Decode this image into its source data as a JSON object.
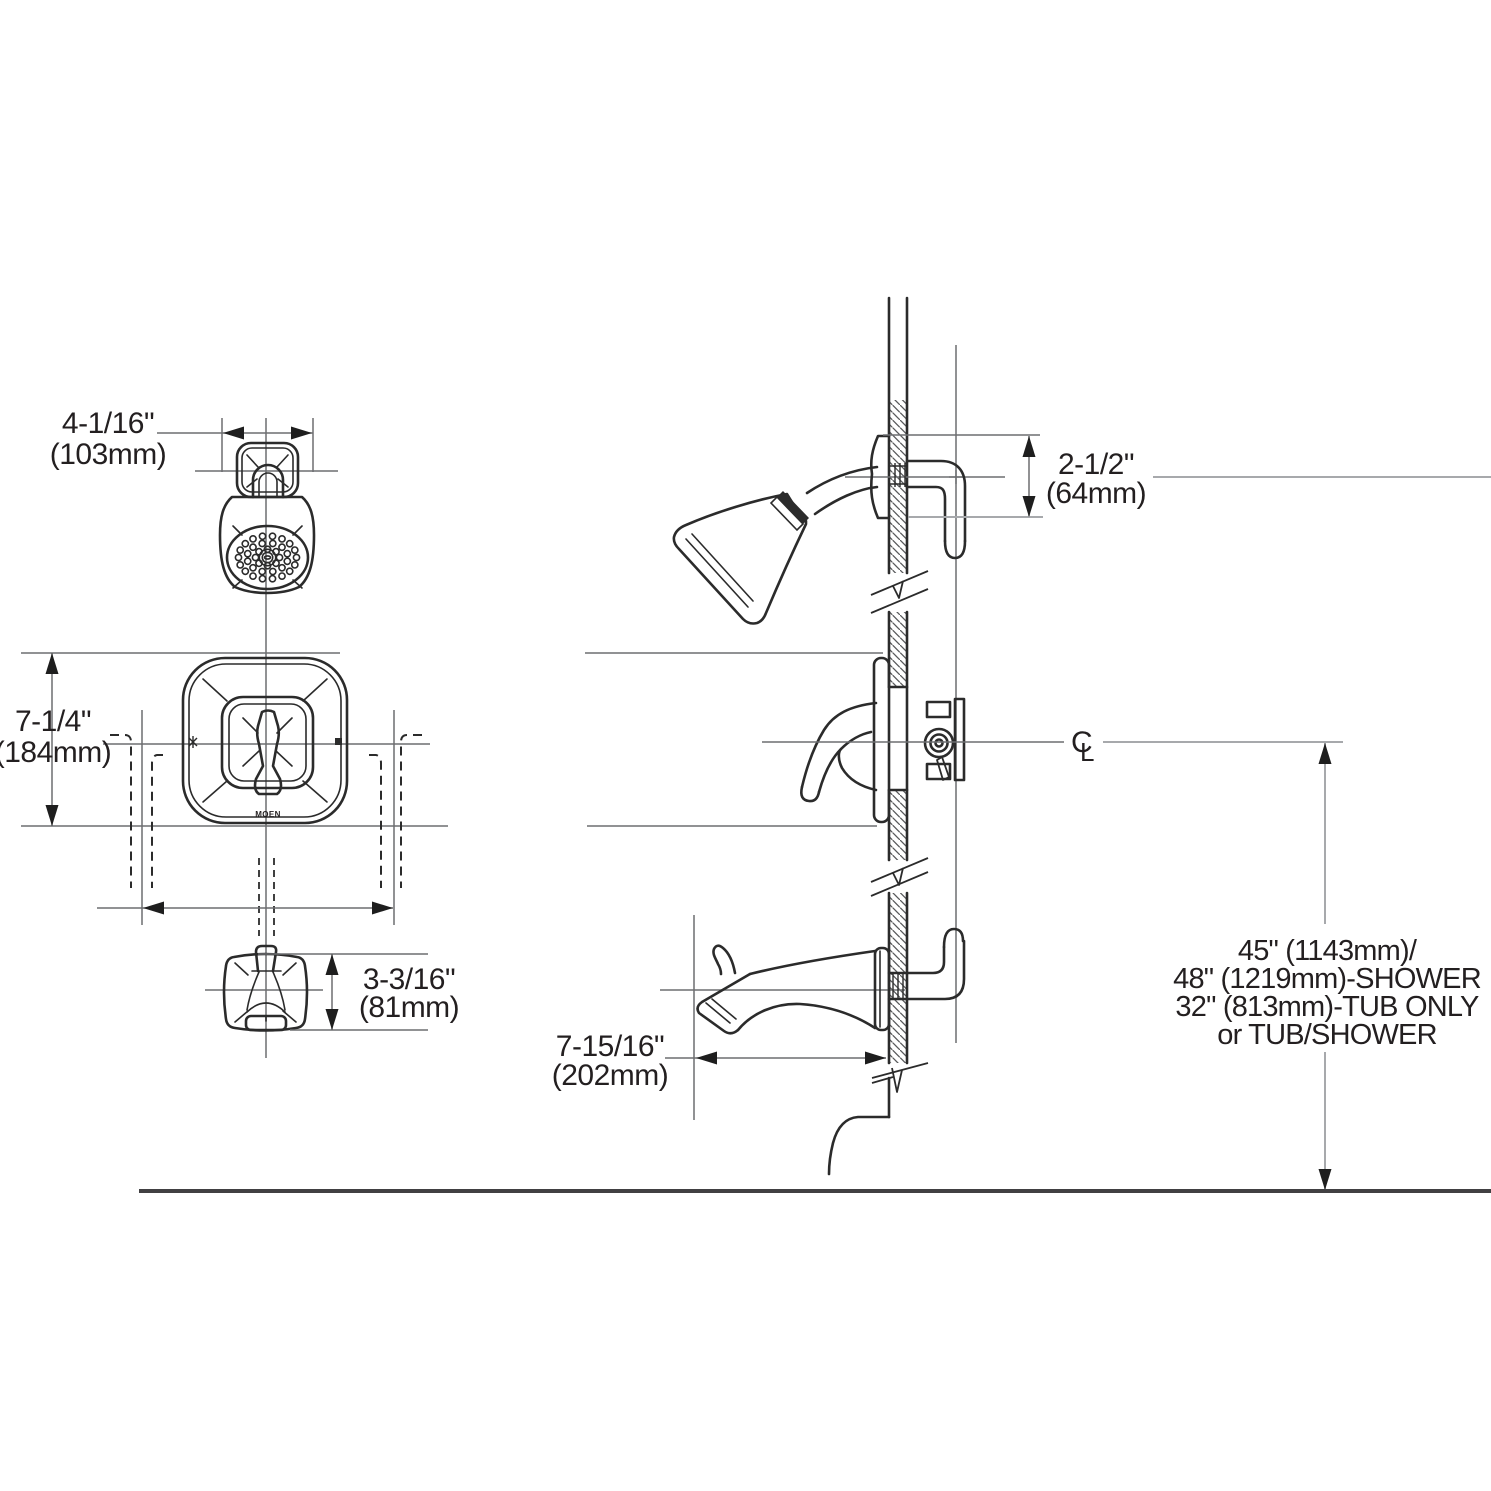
{
  "dims": {
    "head_width_in": "4-1/16\"",
    "head_width_mm": "(103mm)",
    "valve_height_in": "7-1/4\"",
    "valve_height_mm": "(184mm)",
    "spout_height_in": "3-3/16\"",
    "spout_height_mm": "(81mm)",
    "arm_drop_in": "2-1/2\"",
    "arm_drop_mm": "(64mm)",
    "spout_reach_in": "7-15/16\"",
    "spout_reach_mm": "(202mm)",
    "mount_height_line1": "45\" (1143mm)/",
    "mount_height_line2": "48\" (1219mm)-SHOWER",
    "mount_height_line3": "32\" (813mm)-TUB ONLY",
    "mount_height_line4": "or TUB/SHOWER"
  },
  "symbols": {
    "centerline_c": "C",
    "centerline_l": "L",
    "brand": "MOEN"
  },
  "colors": {
    "line": "#2b2b2b",
    "reference": "#6d6e71",
    "light_reference": "#a7a9ac",
    "background": "#ffffff"
  }
}
